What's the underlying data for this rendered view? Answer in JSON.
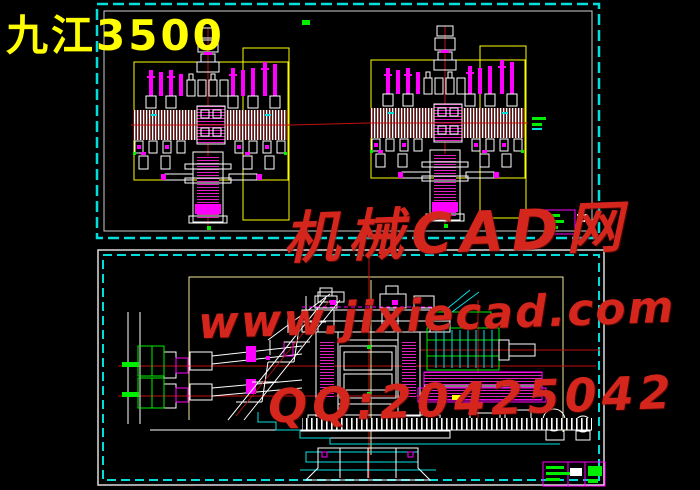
{
  "title": {
    "text": "九江3500",
    "color": "#ffff00"
  },
  "watermark": {
    "color": "#d4261c",
    "line1": "机械CAD网",
    "line2": "www.jixiecad.com",
    "line3": "QQ:20425042"
  },
  "sheets": {
    "sheet1": {
      "name": "screw-down assembly front views (x2)",
      "border_color": "#00dede",
      "frame_color": "#ffff00"
    },
    "sheet2": {
      "name": "3500 mill stand side elevation",
      "border_color": "#00dede",
      "frame_color": "#efe79a"
    }
  },
  "palette": {
    "background": "#000000",
    "linework": "#ffffff",
    "centerline_red": "#cc1010",
    "detail_magenta": "#ff00ff",
    "machine_green": "#00ee00",
    "aux_cyan": "#00e0e0"
  }
}
